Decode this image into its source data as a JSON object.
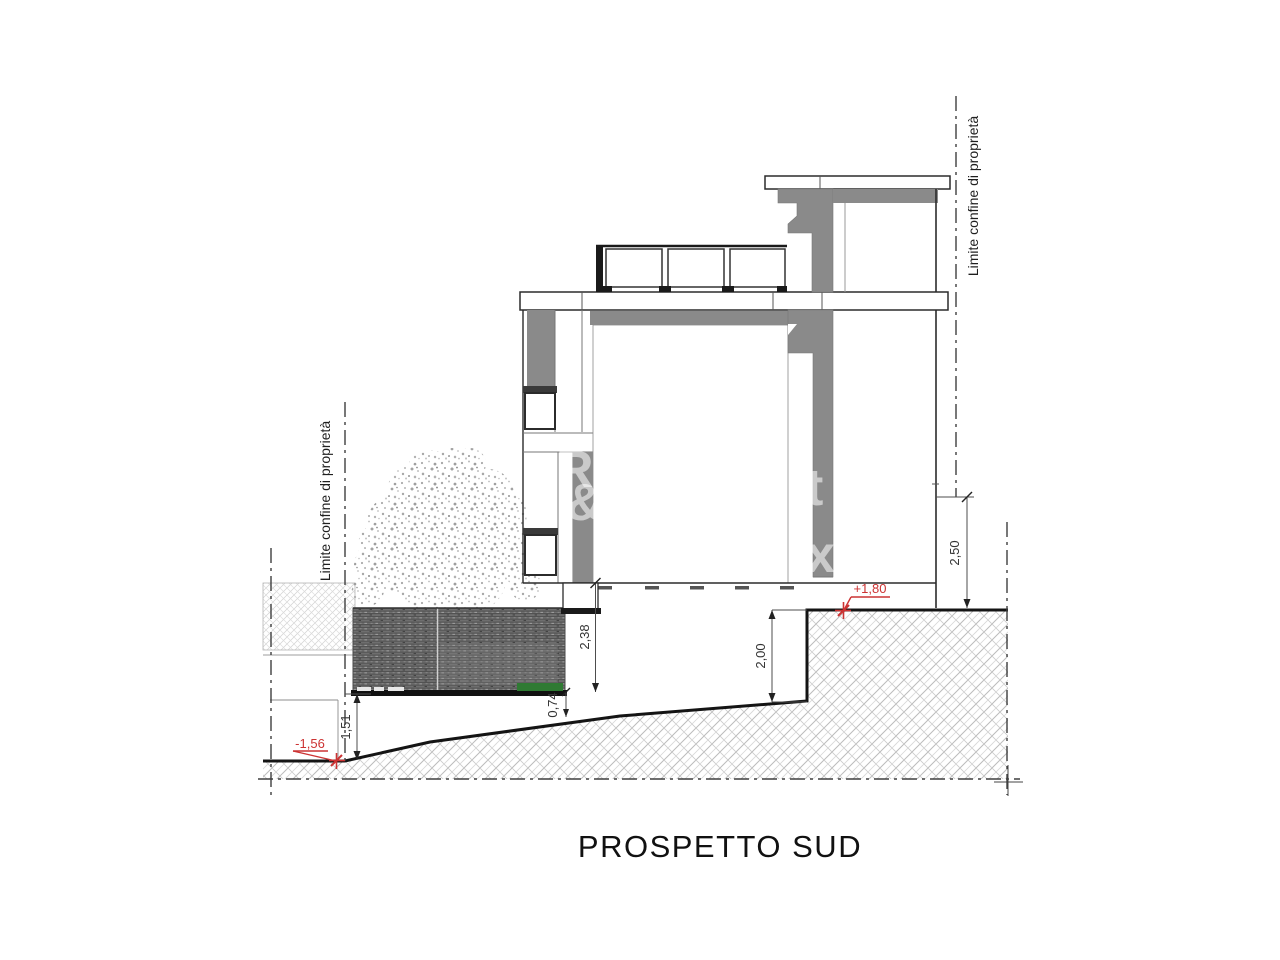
{
  "title": "PROSPETTO SUD",
  "boundaries": {
    "left_label": "Limite confine di proprietà",
    "right_label": "Limite confine di proprietà"
  },
  "dimensions": {
    "right_wall_height": "2,50",
    "building_to_fence_base": "2,38",
    "retaining_step": "2,00",
    "fence_base_to_ground": "1,51",
    "plinth": "0,74"
  },
  "levels": {
    "upper_ground": "+1,80",
    "lower_ground": "-1,56"
  },
  "watermark_letters": {
    "l1": "R",
    "l2": "&",
    "l3": "t",
    "l4": "x"
  },
  "colors": {
    "wall_gray": "#8a8a8a",
    "fence_gray": "#6f6f6f",
    "hedge_green": "#2f7a33",
    "level_marker_red": "#cc3333",
    "line_dark": "#2b2b2b"
  }
}
